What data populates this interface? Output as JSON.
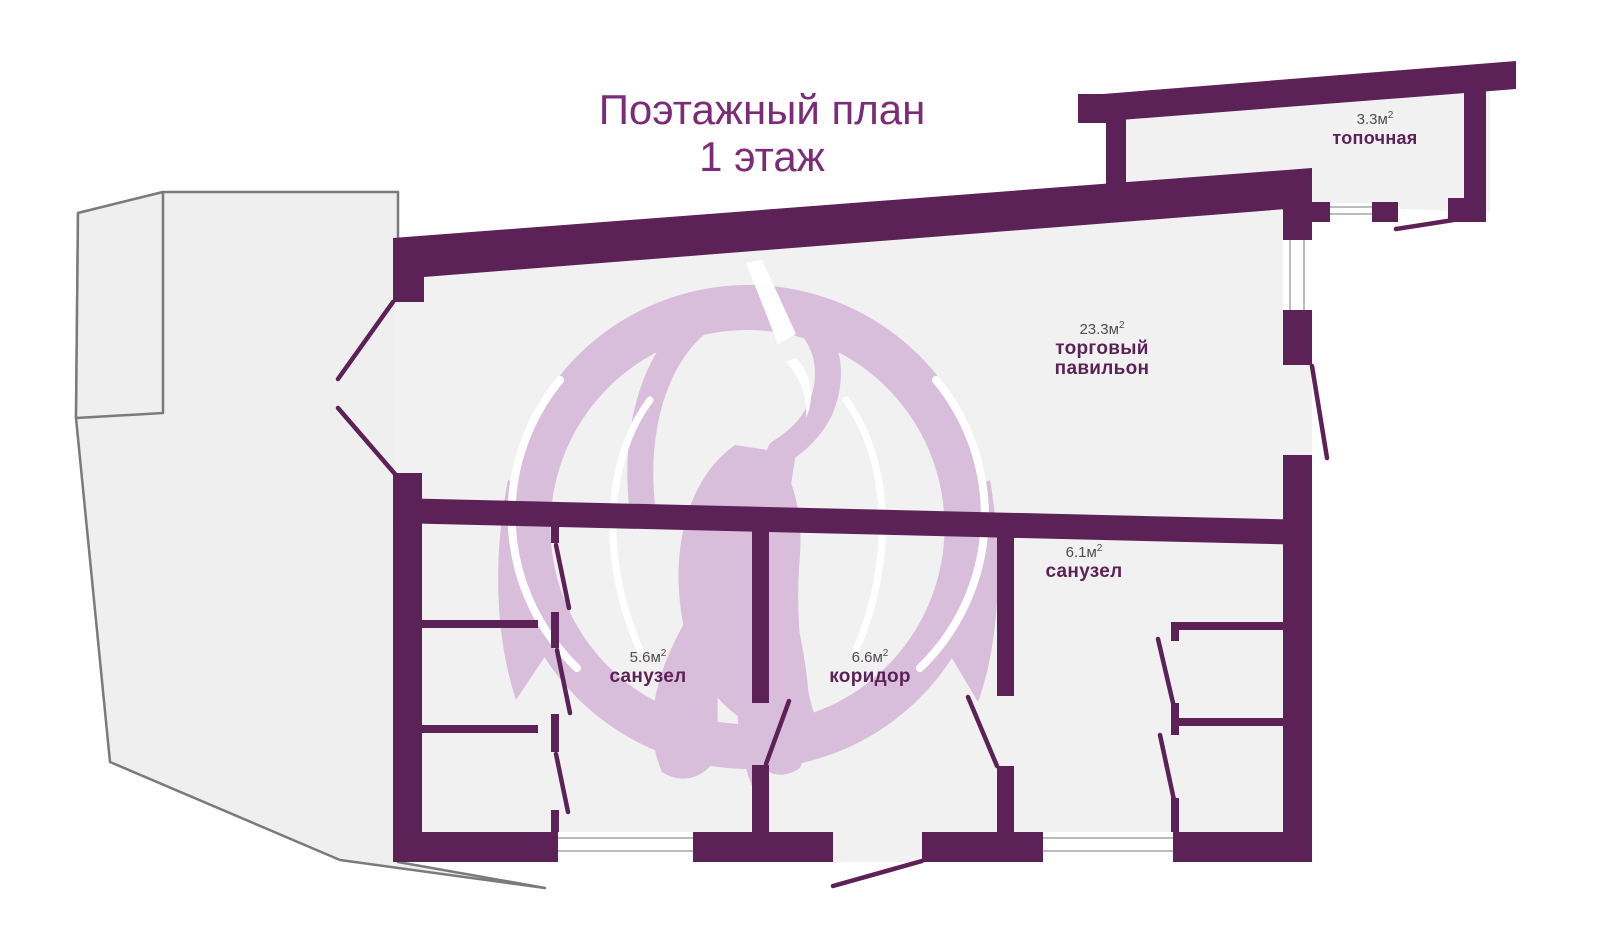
{
  "title": {
    "line1": "Поэтажный план",
    "line2": "1 этаж"
  },
  "rooms": [
    {
      "id": "topochnaya",
      "area": "3.3м",
      "area_sup": "2",
      "name": "топочная"
    },
    {
      "id": "pavilion",
      "area": "23.3м",
      "area_sup": "2",
      "name": "торговый павильон"
    },
    {
      "id": "sanuzel-right",
      "area": "6.1м",
      "area_sup": "2",
      "name": "санузел"
    },
    {
      "id": "sanuzel-left",
      "area": "5.6м",
      "area_sup": "2",
      "name": "санузел"
    },
    {
      "id": "koridor",
      "area": "6.6м",
      "area_sup": "2",
      "name": "коридор"
    }
  ],
  "colors": {
    "wall": "#5c2157",
    "titleText": "#7c2b76",
    "roomName": "#5c2157",
    "areaText": "#4f4b4f",
    "floor": "#f2f1f2",
    "plotFill": "#f0eff0",
    "plotStroke": "#7a7a7a",
    "swan": "#d9bedb",
    "winLine": "#bcbcbc",
    "white": "#ffffff"
  }
}
